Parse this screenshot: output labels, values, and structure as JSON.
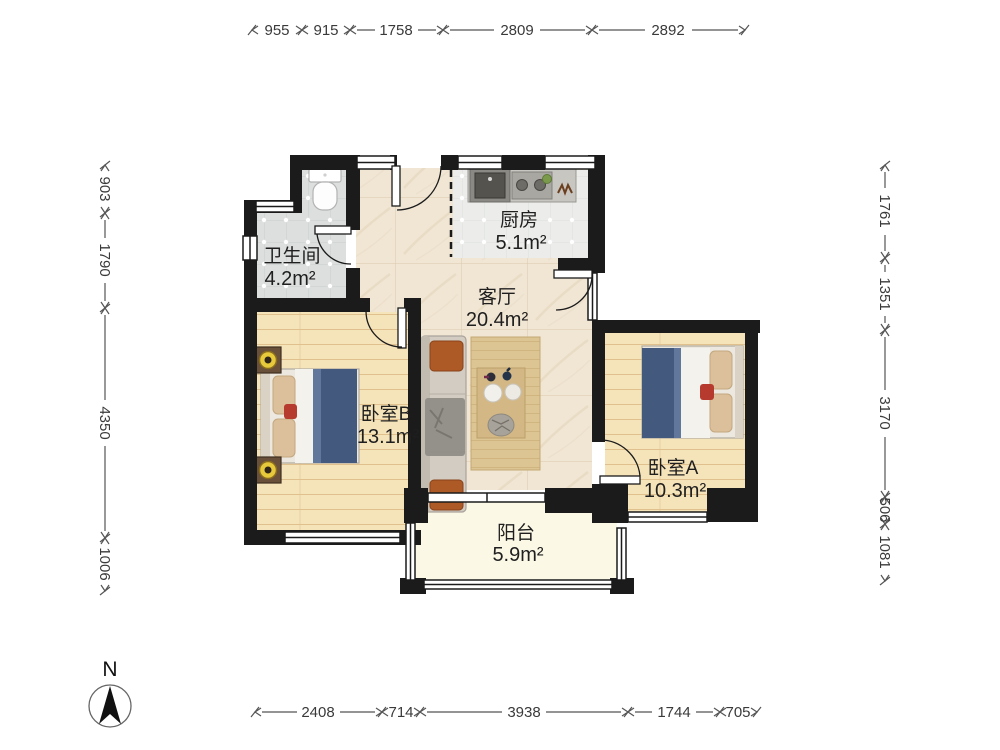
{
  "plan": {
    "compass": {
      "label": "N"
    },
    "rooms": {
      "bathroom": {
        "name": "卫生间",
        "area": "4.2m²"
      },
      "kitchen": {
        "name": "厨房",
        "area": "5.1m²"
      },
      "living": {
        "name": "客厅",
        "area": "20.4m²"
      },
      "bedroom_b": {
        "name": "卧室B",
        "area": "13.1m²"
      },
      "bedroom_a": {
        "name": "卧室A",
        "area": "10.3m²"
      },
      "balcony": {
        "name": "阳台",
        "area": "5.9m²"
      }
    },
    "dimensions_mm": {
      "top": [
        "955",
        "915",
        "1758",
        "2809",
        "2892"
      ],
      "left": [
        "903",
        "1790",
        "4350",
        "1006"
      ],
      "right": [
        "1761",
        "1351",
        "3170",
        "506",
        "1081"
      ],
      "bottom": [
        "2408",
        "714",
        "3938",
        "1744",
        "705"
      ]
    },
    "colors": {
      "wall": "#1b1b1b",
      "living_floor": "#f1e6d4",
      "bedroom_floor": "#f5e3ba",
      "bathroom_floor": "#dcdfde",
      "kitchen_floor": "#ecedea",
      "balcony_floor": "#fbf8e6",
      "bed_blanket": "#44597e",
      "sofa_pillow": "#ad5a26",
      "dimension_text": "#3a3a3a"
    }
  }
}
